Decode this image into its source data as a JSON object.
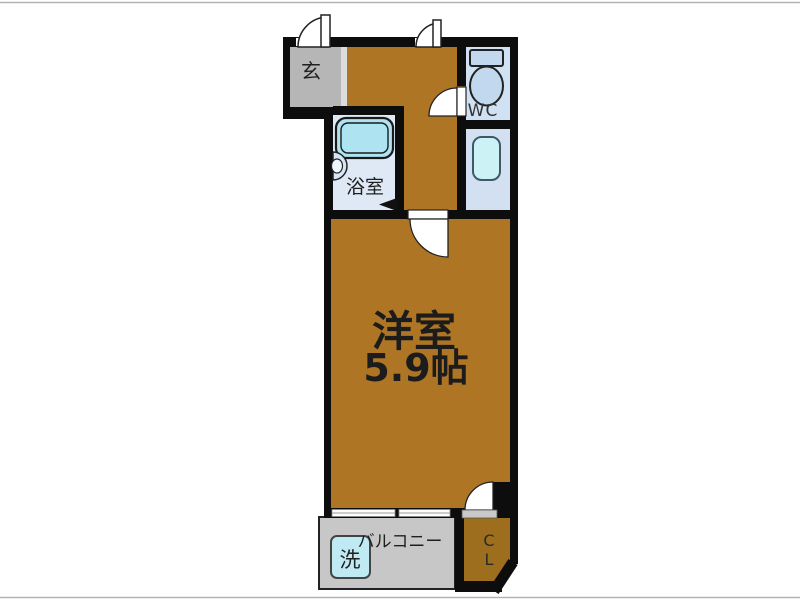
{
  "floorplan": {
    "rooms": {
      "genkan": {
        "label": "玄"
      },
      "bathroom": {
        "label": "浴室"
      },
      "wc": {
        "label": "WC"
      },
      "main_room": {
        "label": "洋室",
        "size": "5.9帖"
      },
      "balcony": {
        "label": "バルコニー"
      },
      "washer": {
        "label": "洗"
      },
      "closet": {
        "label_line1": "C",
        "label_line2": "L"
      }
    },
    "colors": {
      "floor_brown": "#ad7524",
      "closet_brown": "#9c6e1e",
      "genkan_gray": "#b6b6b6",
      "step_gray": "#dcdcdc",
      "balcony_gray": "#c7c7c7",
      "bath_blue": "#dee9f5",
      "tub_cyan": "#aee3f2",
      "wc_blue": "#cfe1f3",
      "toilet_blue": "#c2d8ee",
      "corridor_blue": "#d3e0f2",
      "sink_teal": "#cdf2f6",
      "washer_cyan": "#bfeaf4",
      "door_gray": "#c9c9c9",
      "wall_black": "#0d0d0d"
    }
  }
}
